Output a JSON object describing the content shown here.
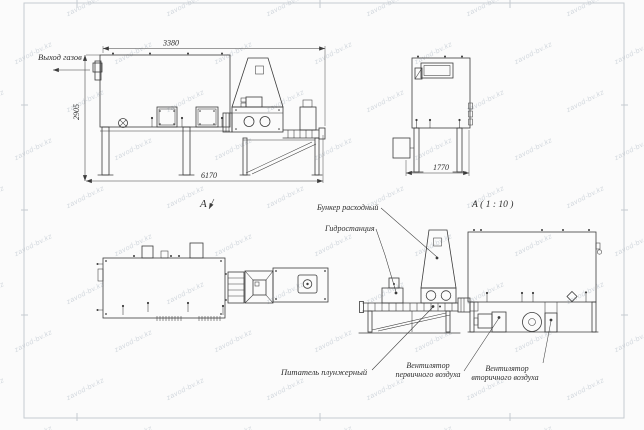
{
  "sheet": {
    "background": "#fbfbfb",
    "line_color": "#3c3c3c",
    "text_color": "#2e2e2e",
    "frame_color": "#c6cbd0"
  },
  "watermark": {
    "text": "zavod-bv.kz"
  },
  "dimensions": {
    "top_width": "3380",
    "left_height": "2905",
    "total_length": "6170",
    "end_width": "1770"
  },
  "labels": {
    "gas_outlet": "Выход газов",
    "view_letter": "А",
    "detail_title": "А ( 1 : 10 )",
    "feed_hopper": "Бункер расходный",
    "hydraulic_station": "Гидростанция",
    "plunger_feeder": "Питатель плунжерный",
    "primary_fan_line1": "Вентилятор",
    "primary_fan_line2": "первичного воздуха",
    "secondary_fan_line1": "Вентилятор",
    "secondary_fan_line2": "вторичного воздуха"
  }
}
